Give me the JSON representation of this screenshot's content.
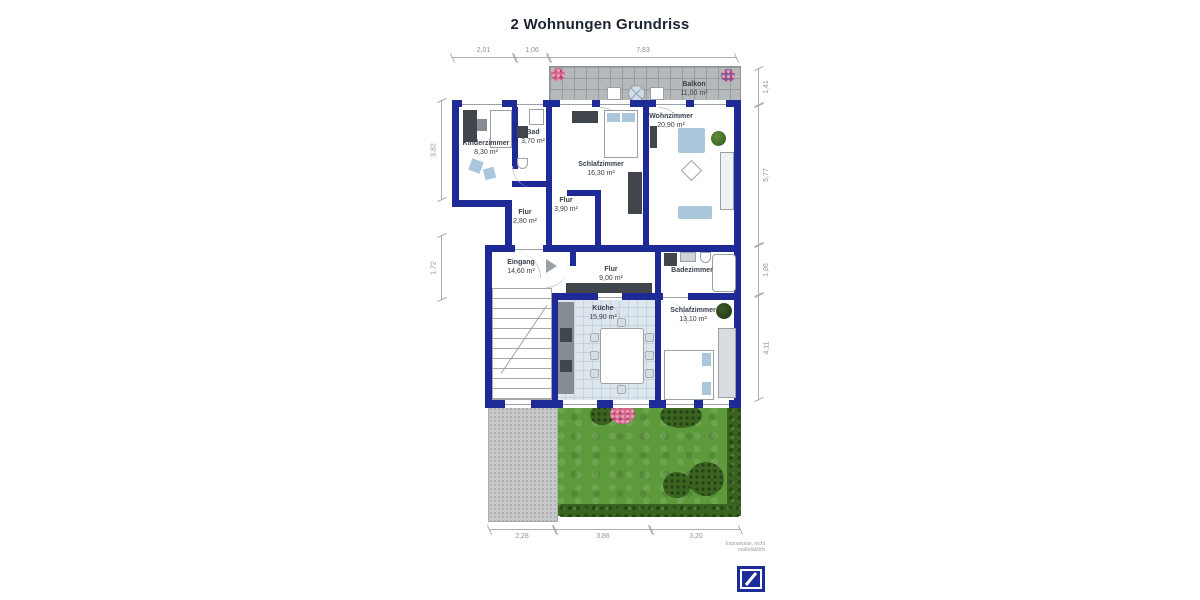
{
  "title": "2 Wohnungen Grundriss",
  "disclaimer": "Exposéplan, nicht maßstäblich",
  "rooms": {
    "balkon": {
      "label": "Balkon",
      "area": "11,00 m²"
    },
    "kinderzimmer": {
      "label": "Kinderzimmer",
      "area": "8,30 m²"
    },
    "bad": {
      "label": "Bad",
      "area": "3,70 m²"
    },
    "schlafzimmer1": {
      "label": "Schlafzimmer",
      "area": "16,30 m²"
    },
    "wohnzimmer": {
      "label": "Wohnzimmer",
      "area": "20,90 m²"
    },
    "flur1": {
      "label": "Flur",
      "area": "3,90 m²"
    },
    "flur2": {
      "label": "Flur",
      "area": "2,80 m²"
    },
    "eingang": {
      "label": "Eingang",
      "area": "14,60 m²"
    },
    "flur3": {
      "label": "Flur",
      "area": "9,00 m²"
    },
    "badezimmer": {
      "label": "Badezimmer"
    },
    "kueche": {
      "label": "Küche",
      "area": "15,90 m²"
    },
    "schlafzimmer2": {
      "label": "Schlafzimmer",
      "area": "13,10 m²"
    }
  },
  "dimensions": {
    "top": [
      "2,01",
      "1,06",
      "7,83"
    ],
    "bottom": [
      "2,28",
      "3,86",
      "3,20"
    ],
    "left": [
      "3,82",
      "1,72"
    ],
    "right": [
      "1,41",
      "5,77",
      "1,86",
      "4,11"
    ]
  },
  "colors": {
    "wall": "#1e2b96",
    "title_text": "#1c2430",
    "label_text": "#39404a",
    "dimension_text": "#8f9498",
    "balcony": "#b6b9bc",
    "patio": "#c7c9ca",
    "lawn": "#5d9a3c",
    "hedge": "#38641f",
    "kitchen_floor": "#dde6ed",
    "furniture_blue": "#a9c6da",
    "logo_blue": "#1c2d9a"
  }
}
